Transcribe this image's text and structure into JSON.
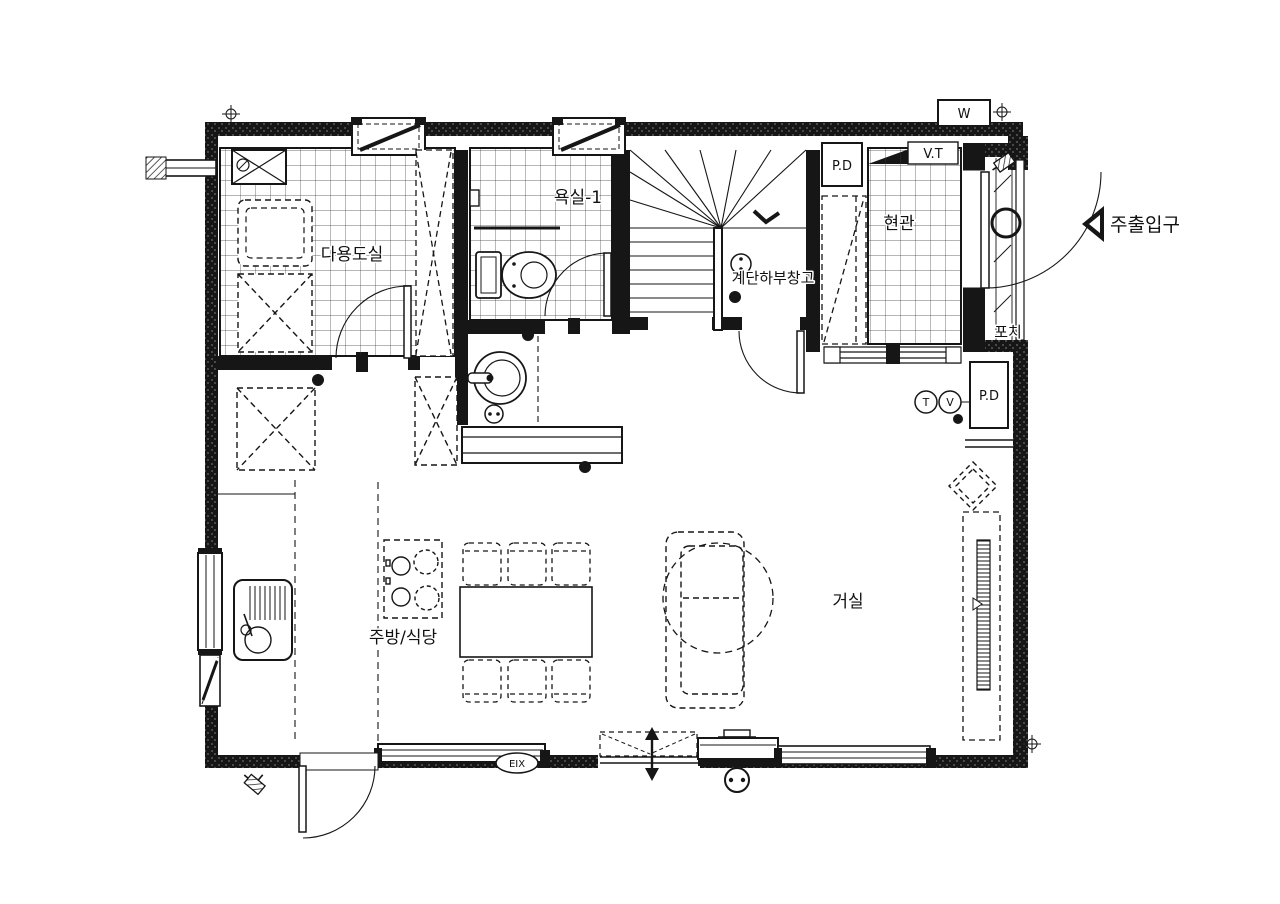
{
  "plan": {
    "rooms": {
      "utility": {
        "label": "다용도실"
      },
      "bathroom1": {
        "label": "욕실-1"
      },
      "understair_storage": {
        "label": "계단하부창고"
      },
      "entrance_hall": {
        "label": "현관"
      },
      "porch": {
        "label": "포치"
      },
      "kitchen_dining": {
        "label": "주방/식당"
      },
      "living_room": {
        "label": "거실"
      }
    },
    "annotations": {
      "pipe_duct_top": "P.D",
      "pipe_duct_right": "P.D",
      "water_meter": "W",
      "vent_terminal": "V.T",
      "tel_outlet": "T",
      "tv_outlet": "V",
      "fixture_tag": "EIX",
      "main_entrance": "주출입구"
    },
    "colors": {
      "ink": "#161616",
      "paper": "#ffffff"
    }
  }
}
